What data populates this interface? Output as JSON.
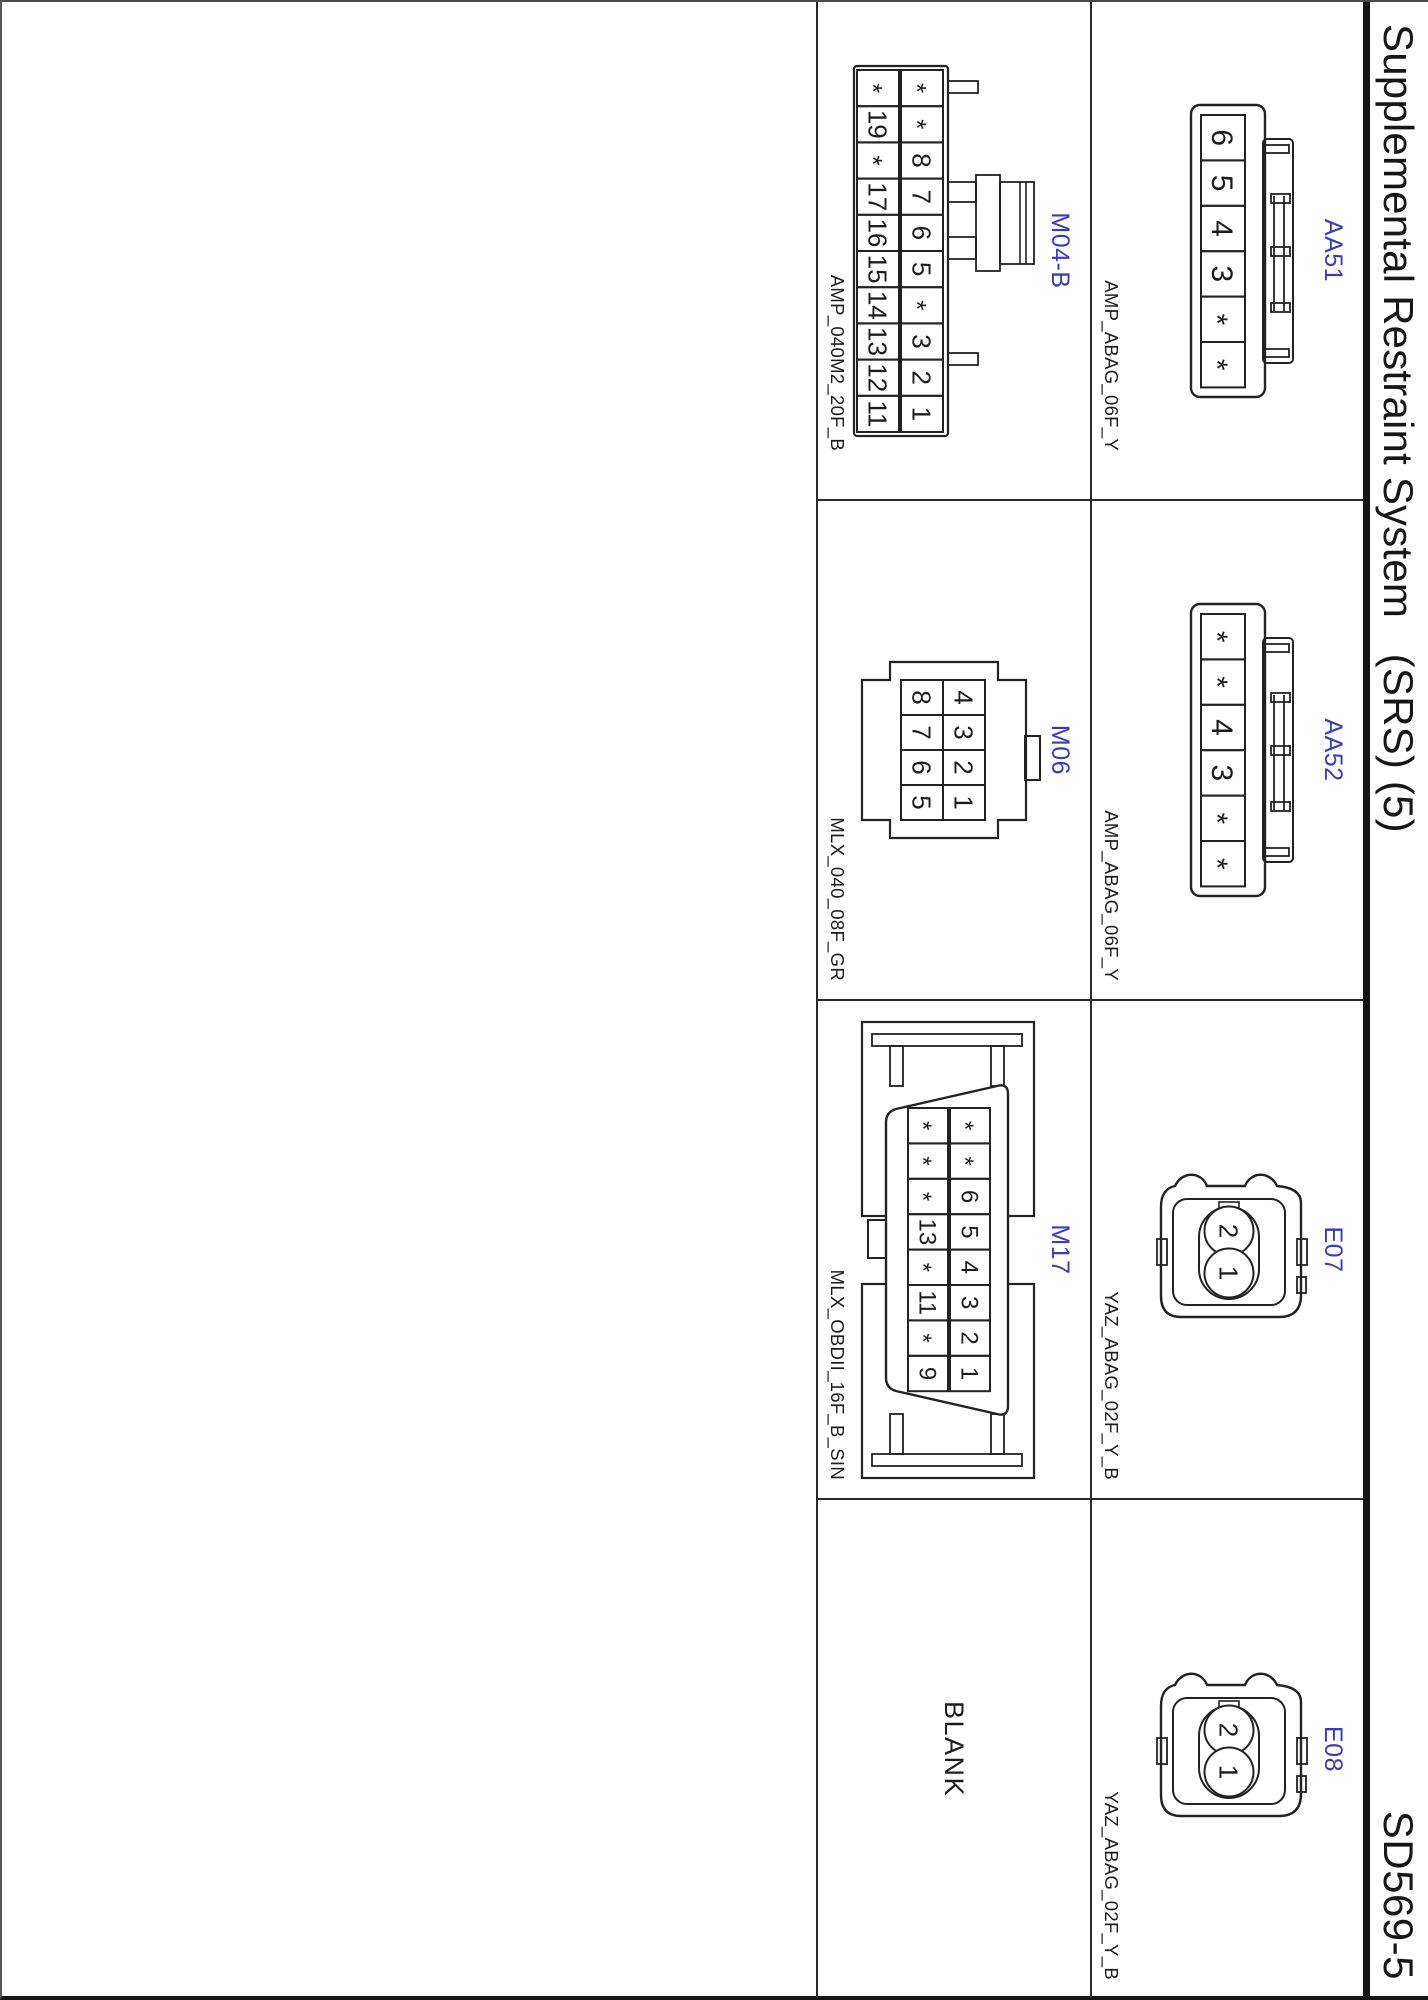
{
  "page": {
    "title": "Supplemental Restraint System   (SRS) (5)",
    "doc_number": "SD569-5",
    "accent_color": "#3a3ac4",
    "line_color": "#222222",
    "background_color": "#ffffff"
  },
  "cells": [
    {
      "id": "AA51",
      "label": "AA51",
      "part_number": "AMP_ABAG_06F_Y",
      "connector_type": "amp-airbag-6pin",
      "pins": [
        "6",
        "5",
        "4",
        "3",
        "*",
        "*"
      ]
    },
    {
      "id": "AA52",
      "label": "AA52",
      "part_number": "AMP_ABAG_06F_Y",
      "connector_type": "amp-airbag-6pin",
      "pins": [
        "*",
        "*",
        "4",
        "3",
        "*",
        "*"
      ]
    },
    {
      "id": "E07",
      "label": "E07",
      "part_number": "YAZ_ABAG_02F_Y_B",
      "connector_type": "yazaki-2pin-round",
      "pins": [
        "2",
        "1"
      ]
    },
    {
      "id": "E08",
      "label": "E08",
      "part_number": "YAZ_ABAG_02F_Y_B",
      "connector_type": "yazaki-2pin-round",
      "pins": [
        "2",
        "1"
      ]
    },
    {
      "id": "M04-B",
      "label": "M04-B",
      "part_number": "AMP_040M2_20F_B",
      "connector_type": "amp-040-20pin",
      "pins_top": [
        "*",
        "*",
        "8",
        "7",
        "6",
        "5",
        "*",
        "3",
        "2",
        "1"
      ],
      "pins_bottom": [
        "*",
        "19",
        "*",
        "17",
        "16",
        "15",
        "14",
        "13",
        "12",
        "11"
      ]
    },
    {
      "id": "M06",
      "label": "M06",
      "part_number": "MLX_040_08F_GR",
      "connector_type": "molex-040-8pin",
      "pins_top": [
        "4",
        "3",
        "2",
        "1"
      ],
      "pins_bottom": [
        "8",
        "7",
        "6",
        "5"
      ]
    },
    {
      "id": "M17",
      "label": "M17",
      "part_number": "MLX_OBDII_16F_B_SIN",
      "connector_type": "molex-obd2-16pin",
      "pins_top": [
        "*",
        "*",
        "6",
        "5",
        "4",
        "3",
        "2",
        "1"
      ],
      "pins_bottom": [
        "*",
        "*",
        "*",
        "13",
        "*",
        "11",
        "*",
        "9"
      ]
    },
    {
      "id": "BLANK",
      "label": "BLANK",
      "blank": true
    }
  ]
}
